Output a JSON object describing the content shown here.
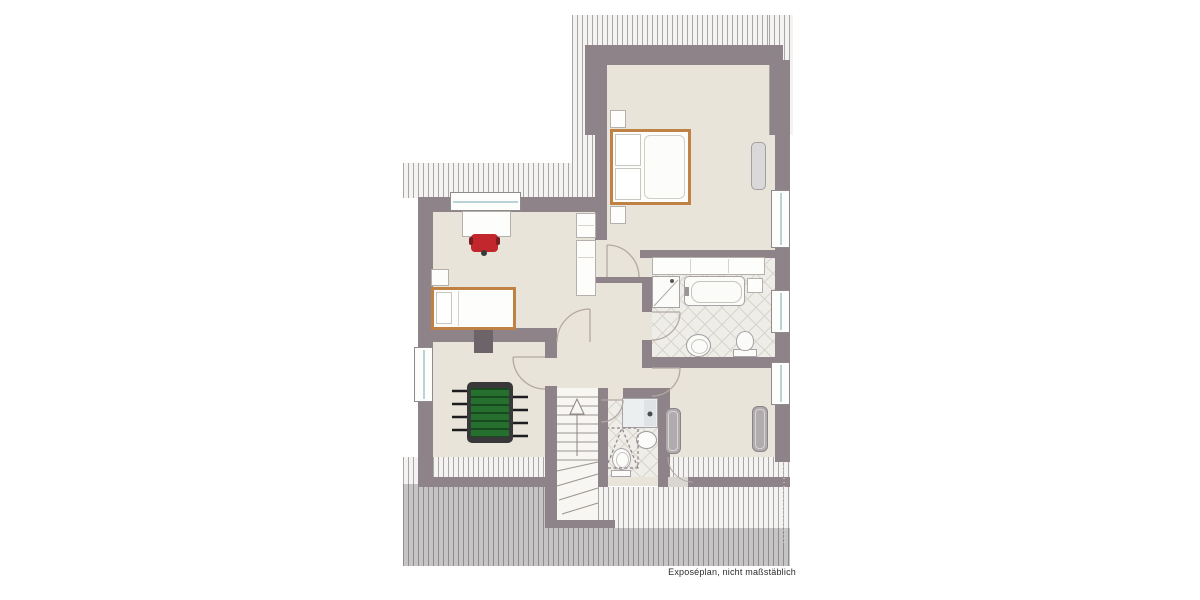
{
  "document": {
    "caption": "Exposéplan, nicht maßstäblich",
    "type_note": "architectural floor plan drawing, attic storey, no room labels printed"
  },
  "colors": {
    "wall": "#8d8389",
    "wall-dark": "#6c6468",
    "floor": "#e9e4d9",
    "floor-light": "#f7f6f2",
    "tile-bg": "#efede8",
    "tile-line": "#d8d5ce",
    "hatch-line": "#a9a7a6",
    "hatch-light-bg": "#f4f3f1",
    "hatch-dark-line": "#8f8c8e",
    "hatch-dark-bg": "#c7c4c5",
    "bed-frame": "#c08145",
    "chair-red": "#c1272d",
    "foosball-body": "#38383a",
    "foosball-green": "#26702f",
    "radiator": "#b0abad",
    "glazing": "#b7d3d6",
    "arc-line": "#b3a9a1",
    "caption-ink": "#2b2b2b"
  },
  "plan": {
    "regions": [
      "bedroom-with-dormer",
      "children-room",
      "bathroom",
      "shower-wc",
      "hallway",
      "playroom",
      "staircase",
      "roof-eaves-storage"
    ],
    "furniture_icons": [
      "double-bed",
      "nightstand",
      "single-bed",
      "desk",
      "red-desk-chair",
      "wardrobe-cabinet",
      "sideboard-vanity",
      "foosball-table",
      "shelf"
    ],
    "fixtures": [
      "bathtub",
      "shower",
      "washbasin",
      "toilet",
      "radiator",
      "staircase-up-arrow"
    ],
    "window_count": 5,
    "door_count": 7
  }
}
